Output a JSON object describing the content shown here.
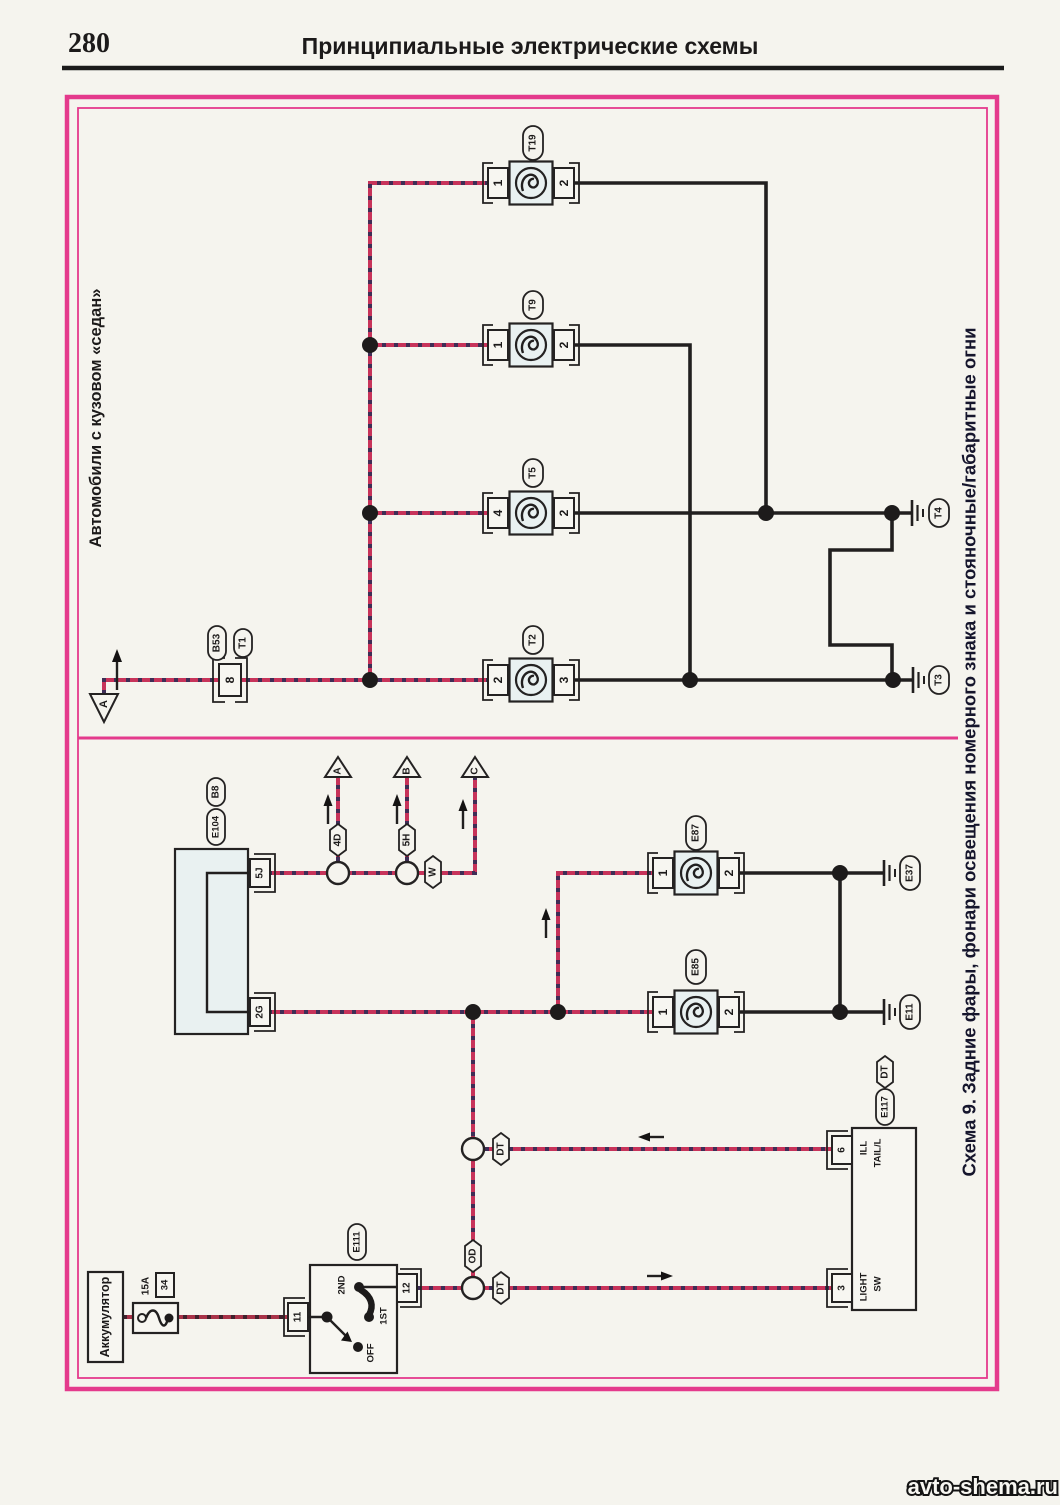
{
  "page": {
    "number": "280",
    "title": "Принципиальные электрические схемы",
    "watermark": "avto-shema.ru"
  },
  "frame": {
    "sedan_label": "Автомобили с кузовом «седан»",
    "scheme_title": "Схема 9. Задние фары, фонари освещения номерного знака и стояночные/габаритные огни"
  },
  "colors": {
    "frame_pink": "#e43a8c",
    "wire_red": "#c7335a",
    "wire_hatch": "#3f2d56",
    "wire_black": "#211f1f",
    "lamp_fill": "#e9f1f1",
    "paper": "#f5f4ee"
  },
  "top_section": {
    "source_arrow": "A",
    "connector": {
      "label_1": "B53",
      "label_2": "T1",
      "pin": "8"
    },
    "lamps": [
      {
        "id": "T19",
        "pin_left": "1",
        "pin_right": "2"
      },
      {
        "id": "T9",
        "pin_left": "1",
        "pin_right": "2"
      },
      {
        "id": "T5",
        "pin_left": "4",
        "pin_right": "2"
      },
      {
        "id": "T2",
        "pin_left": "2",
        "pin_right": "3"
      }
    ],
    "grounds": [
      {
        "id": "T4"
      },
      {
        "id": "T3"
      }
    ]
  },
  "bottom_section": {
    "block": {
      "label_1": "B8",
      "label_2": "E104",
      "pin_top": "5J",
      "pin_bottom": "2G"
    },
    "branch_arrows": [
      {
        "id": "A",
        "conn": "4D"
      },
      {
        "id": "B",
        "conn": "5H"
      },
      {
        "id": "C",
        "conn": "W"
      }
    ],
    "lamps": [
      {
        "id": "E87",
        "pin_left": "1",
        "pin_right": "2",
        "ground": "E37"
      },
      {
        "id": "E85",
        "pin_left": "1",
        "pin_right": "2",
        "ground": "E11"
      }
    ],
    "inline_connectors": {
      "od": "OD",
      "dt_upper": "DT",
      "dt_lower": "DT",
      "dt_block": "DT"
    },
    "light_switch": {
      "id": "E111",
      "pin_in": "11",
      "pin_out": "12",
      "positions": {
        "off": "OFF",
        "first": "1ST",
        "second": "2ND"
      }
    },
    "battery": {
      "label": "Аккумулятор",
      "fuse_rating": "15A",
      "fuse_number": "34"
    },
    "tail_block": {
      "id": "E117",
      "pin_ill": "6",
      "pin_sw": "3",
      "ill_line1": "ILL",
      "ill_line2": "TAIL/L",
      "sw_line1": "LIGHT",
      "sw_line2": "SW"
    }
  }
}
